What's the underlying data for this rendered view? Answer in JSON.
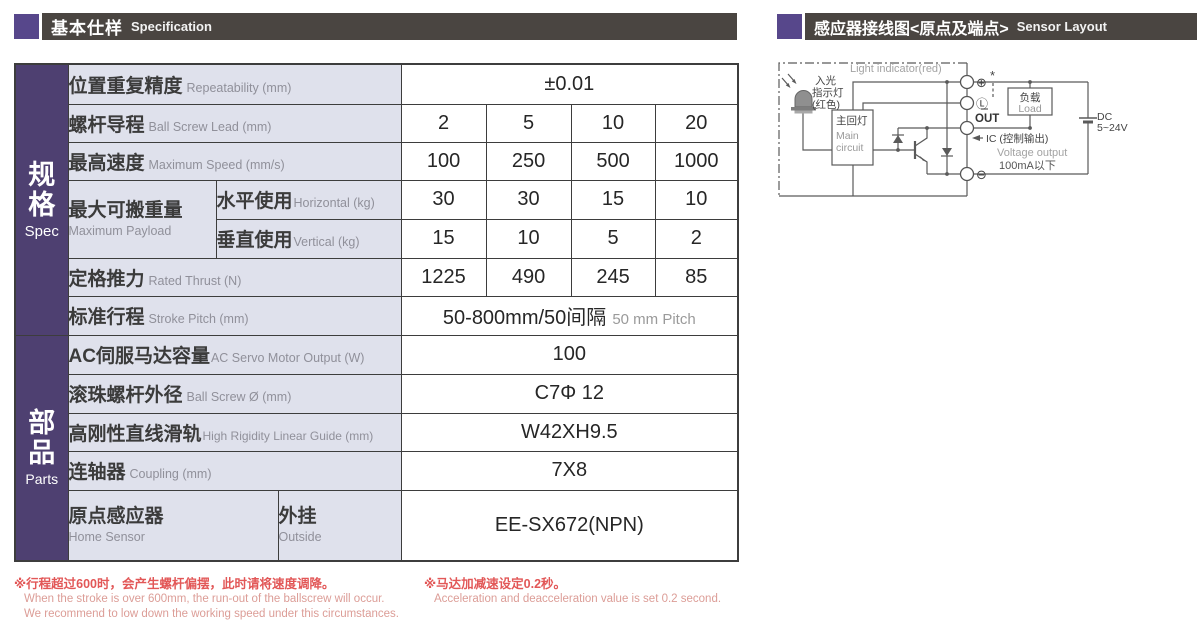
{
  "colors": {
    "accent_purple": "#57478b",
    "sidebar_purple": "#4e4071",
    "header_bar": "#4a4541",
    "label_bg": "#dfe1ec",
    "note_red": "#e25757",
    "note_light_red": "#dc9d97"
  },
  "header_left": {
    "zh": "基本仕样",
    "en": "Specification"
  },
  "header_right": {
    "zh": "感应器接线图<原点及端点>",
    "en": "Sensor Layout"
  },
  "sidebar": {
    "spec": {
      "chars": [
        "规",
        "格"
      ],
      "en": "Spec"
    },
    "parts": {
      "chars": [
        "部",
        "品"
      ],
      "en": "Parts"
    }
  },
  "spec_table": {
    "repeatability": {
      "zh": "位置重复精度",
      "en": "Repeatability (mm)",
      "value": "±0.01"
    },
    "ball_screw_lead": {
      "zh": "螺杆导程",
      "en": "Ball Screw Lead (mm)",
      "values": [
        "2",
        "5",
        "10",
        "20"
      ]
    },
    "max_speed": {
      "zh": "最高速度",
      "en": "Maximum Speed (mm/s)",
      "values": [
        "100",
        "250",
        "500",
        "1000"
      ]
    },
    "max_payload": {
      "zh": "最大可搬重量",
      "en": "Maximum Payload",
      "horizontal": {
        "zh": "水平使用",
        "en": "Horizontal (kg)",
        "values": [
          "30",
          "30",
          "15",
          "10"
        ]
      },
      "vertical": {
        "zh": "垂直使用",
        "en": "Vertical (kg)",
        "values": [
          "15",
          "10",
          "5",
          "2"
        ]
      }
    },
    "rated_thrust": {
      "zh": "定格推力",
      "en": "Rated Thrust (N)",
      "values": [
        "1225",
        "490",
        "245",
        "85"
      ]
    },
    "stroke_pitch": {
      "zh": "标准行程",
      "en": "Stroke Pitch (mm)",
      "value_zh": "50-800mm/50间隔",
      "value_en": "50 mm Pitch"
    },
    "servo_output": {
      "zh": "AC伺服马达容量",
      "en": "AC Servo Motor Output (W)",
      "value": "100"
    },
    "ball_screw_dia": {
      "zh": "滚珠螺杆外径",
      "en": "Ball Screw Ø (mm)",
      "value": "C7Φ 12"
    },
    "linear_guide": {
      "zh": "高刚性直线滑轨",
      "en": "High Rigidity Linear Guide (mm)",
      "value": "W42XH9.5"
    },
    "coupling": {
      "zh": "连轴器",
      "en": "Coupling (mm)",
      "value": "7X8"
    },
    "home_sensor": {
      "zh": "原点感应器",
      "en": "Home Sensor",
      "sub_zh": "外挂",
      "sub_en": "Outside",
      "value": "EE-SX672(NPN)"
    }
  },
  "notes": {
    "note1_zh": "※行程超过600时，会产生螺杆偏摆，此时请将速度调降。",
    "note1_en1": "When the stroke is over 600mm, the run-out of the ballscrew will occur.",
    "note1_en2": "We recommend to low down the working speed under this circumstances.",
    "note2_zh": "※马达加减速设定0.2秒。",
    "note2_en": "Acceleration and deacceleration value is set 0.2 second."
  },
  "diagram": {
    "light_indicator": "Light indicator(red)",
    "led_label": [
      "入光",
      "指示灯",
      "(红色)"
    ],
    "main_circuit": {
      "zh": "主回灯",
      "en1": "Main",
      "en2": "circuit"
    },
    "terminals": {
      "plus": "⊕",
      "star": "*",
      "l": "Ⓛ",
      "out": "OUT",
      "minus": "⊖"
    },
    "load": {
      "zh": "负载",
      "en": "Load"
    },
    "ic_label": "IC (控制输出)",
    "voltage_output": "Voltage output",
    "current_note": "100mA以下",
    "dc": {
      "line1": "DC",
      "line2": "5~24V"
    }
  }
}
